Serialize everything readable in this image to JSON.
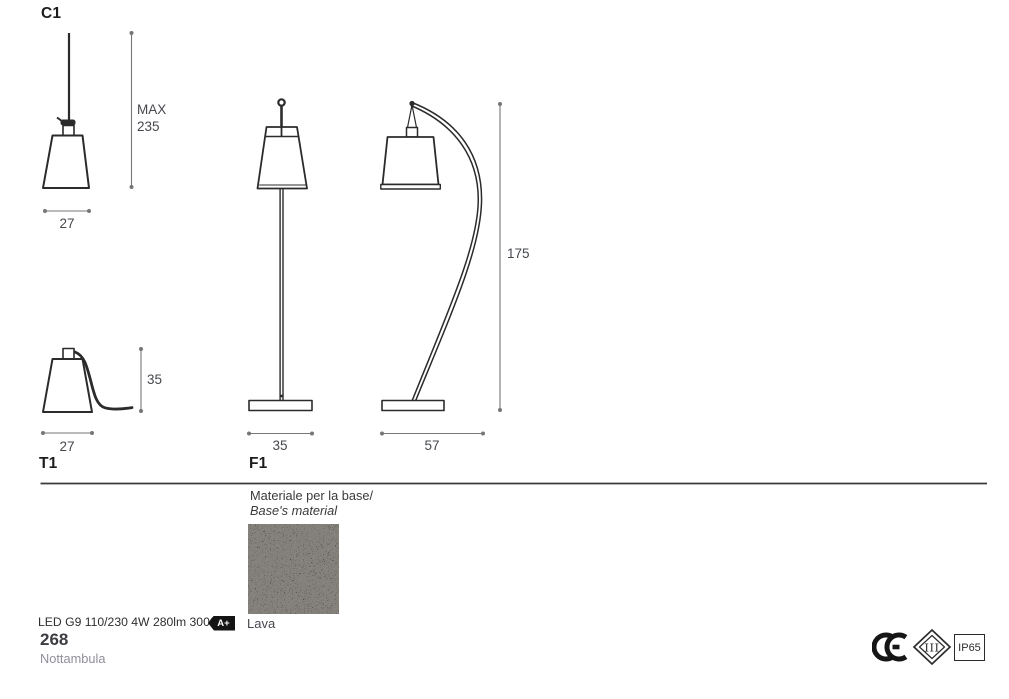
{
  "page": {
    "section_labels": {
      "c1": "C1",
      "t1": "T1",
      "f1": "F1"
    },
    "dimensions": {
      "pendant_max_label": "MAX",
      "pendant_max_value": "235",
      "pendant_width": "27",
      "table_height": "35",
      "table_width": "27",
      "floor_front_width": "35",
      "floor_side_width": "57",
      "floor_height": "175"
    },
    "material": {
      "label_it": "Materiale per la base/",
      "label_en": "Base's material",
      "swatch_name": "Lava",
      "swatch_color": "#5e5d5a"
    },
    "specs": {
      "lamp": "LED G9 110/230 4W 280lm 3000°K",
      "energy_class": "A+"
    },
    "footer": {
      "page_number": "268",
      "product_name": "Nottambula"
    },
    "certifications": {
      "class_symbol": "III",
      "ip_rating": "IP65"
    },
    "colors": {
      "line": "#2b2b2b",
      "dimension_line": "#767676",
      "dimension_text": "#46484e"
    }
  }
}
